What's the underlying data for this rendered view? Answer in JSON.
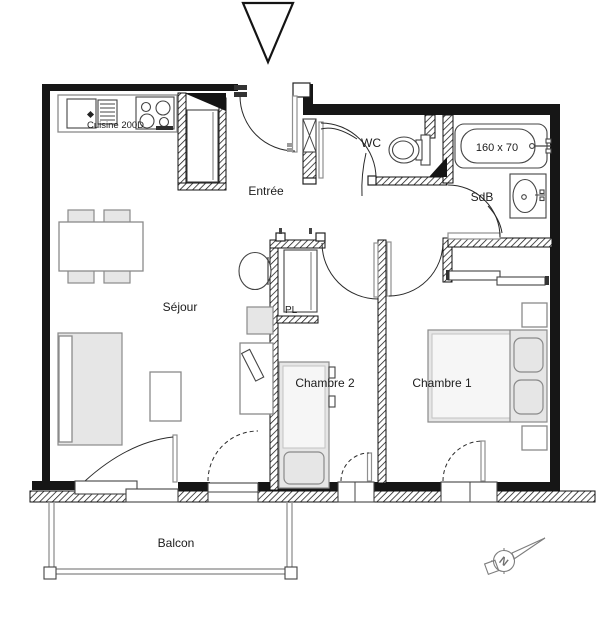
{
  "rooms": {
    "kitchen_label": "Cuisine 200D",
    "entry_label": "Entrée",
    "wc_label": "WC",
    "bathroom_label": "SdB",
    "living_label": "Séjour",
    "closet_label": "PL",
    "bedroom2_label": "Chambre 2",
    "bedroom1_label": "Chambre 1",
    "balcony_label": "Balcon"
  },
  "annotations": {
    "bathtub_size": "160 x 70",
    "compass_north": "N"
  },
  "colors": {
    "wall": "#161616",
    "line": "#8a8a8a",
    "furniture_fill": "#e6e6e6",
    "balcony": "#9a9a9a",
    "text": "#1c1c1c"
  }
}
